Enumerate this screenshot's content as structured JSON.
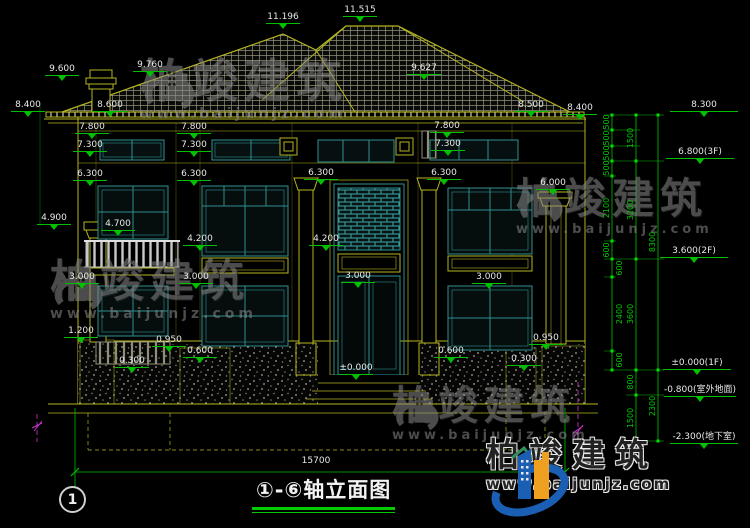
{
  "title": {
    "text": "①-⑥轴立面图",
    "axis_bubble": "1"
  },
  "watermark": {
    "brand": "柏竣建筑",
    "url": "www.baijunjz.com"
  },
  "footer_logo": {
    "brand": "柏竣建筑",
    "url": "www.baijunjz.com"
  },
  "colors": {
    "background": "#000000",
    "cad_yellow": "#b5b520",
    "cad_teal": "#2f8f8f",
    "dim_green": "#00c000",
    "text_white": "#e8e8e8",
    "axis_magenta": "#cc33cc",
    "logo_blue": "#1a5fb4",
    "logo_orange": "#f0a020"
  },
  "labels": {
    "dims": [
      {
        "t": "11.196",
        "x": 283,
        "y": 12
      },
      {
        "t": "11.515",
        "x": 360,
        "y": 5
      },
      {
        "t": "9.600",
        "x": 62,
        "y": 64
      },
      {
        "t": "9.760",
        "x": 150,
        "y": 60
      },
      {
        "t": "9.627",
        "x": 424,
        "y": 63
      },
      {
        "t": "8.400",
        "x": 28,
        "y": 100
      },
      {
        "t": "8.600",
        "x": 110,
        "y": 100
      },
      {
        "t": "8.500",
        "x": 531,
        "y": 100
      },
      {
        "t": "8.400",
        "x": 580,
        "y": 103
      },
      {
        "t": "7.800",
        "x": 92,
        "y": 122
      },
      {
        "t": "7.800",
        "x": 194,
        "y": 122
      },
      {
        "t": "7.800",
        "x": 447,
        "y": 121
      },
      {
        "t": "7.300",
        "x": 90,
        "y": 140
      },
      {
        "t": "7.300",
        "x": 194,
        "y": 140
      },
      {
        "t": "7.300",
        "x": 448,
        "y": 139
      },
      {
        "t": "6.300",
        "x": 90,
        "y": 169
      },
      {
        "t": "6.300",
        "x": 194,
        "y": 169
      },
      {
        "t": "6.300",
        "x": 321,
        "y": 168
      },
      {
        "t": "6.300",
        "x": 444,
        "y": 168
      },
      {
        "t": "6.000",
        "x": 553,
        "y": 178
      },
      {
        "t": "4.900",
        "x": 54,
        "y": 213
      },
      {
        "t": "4.700",
        "x": 118,
        "y": 219
      },
      {
        "t": "4.200",
        "x": 200,
        "y": 234
      },
      {
        "t": "4.200",
        "x": 326,
        "y": 234
      },
      {
        "t": "3.000",
        "x": 82,
        "y": 272
      },
      {
        "t": "3.000",
        "x": 196,
        "y": 272
      },
      {
        "t": "3.000",
        "x": 358,
        "y": 271
      },
      {
        "t": "3.000",
        "x": 489,
        "y": 272
      },
      {
        "t": "1.200",
        "x": 81,
        "y": 326
      },
      {
        "t": "0.950",
        "x": 169,
        "y": 335
      },
      {
        "t": "0.950",
        "x": 546,
        "y": 333
      },
      {
        "t": "0.600",
        "x": 200,
        "y": 346
      },
      {
        "t": "0.600",
        "x": 451,
        "y": 346
      },
      {
        "t": "0.300",
        "x": 132,
        "y": 356
      },
      {
        "t": "0.300",
        "x": 524,
        "y": 354
      },
      {
        "t": "±0.000",
        "x": 356,
        "y": 363
      },
      {
        "t": "15700",
        "x": 316,
        "y": 456,
        "cls": "plain"
      }
    ],
    "levels": [
      {
        "t": "8.300",
        "x": 704,
        "y": 100
      },
      {
        "t": "6.800(3F)",
        "x": 700,
        "y": 147
      },
      {
        "t": "3.600(2F)",
        "x": 694,
        "y": 246
      },
      {
        "t": "±0.000(1F)",
        "x": 697,
        "y": 358
      },
      {
        "t": "-0.800(室外地面)",
        "x": 700,
        "y": 385
      },
      {
        "t": "-2.300(地下室)",
        "x": 704,
        "y": 432
      }
    ],
    "chains": [
      {
        "t": "500",
        "x": 607,
        "y": 122
      },
      {
        "t": "500",
        "x": 607,
        "y": 138
      },
      {
        "t": "500",
        "x": 607,
        "y": 153
      },
      {
        "t": "500",
        "x": 607,
        "y": 168
      },
      {
        "t": "2100",
        "x": 607,
        "y": 208
      },
      {
        "t": "600",
        "x": 607,
        "y": 250
      },
      {
        "t": "600",
        "x": 620,
        "y": 268
      },
      {
        "t": "2400",
        "x": 620,
        "y": 314
      },
      {
        "t": "600",
        "x": 620,
        "y": 360
      },
      {
        "t": "800",
        "x": 631,
        "y": 382
      },
      {
        "t": "1500",
        "x": 631,
        "y": 418
      },
      {
        "t": "1500",
        "x": 631,
        "y": 138
      },
      {
        "t": "3200",
        "x": 631,
        "y": 210
      },
      {
        "t": "3600",
        "x": 631,
        "y": 314
      },
      {
        "t": "2300",
        "x": 653,
        "y": 406
      },
      {
        "t": "8300",
        "x": 653,
        "y": 242
      }
    ]
  }
}
